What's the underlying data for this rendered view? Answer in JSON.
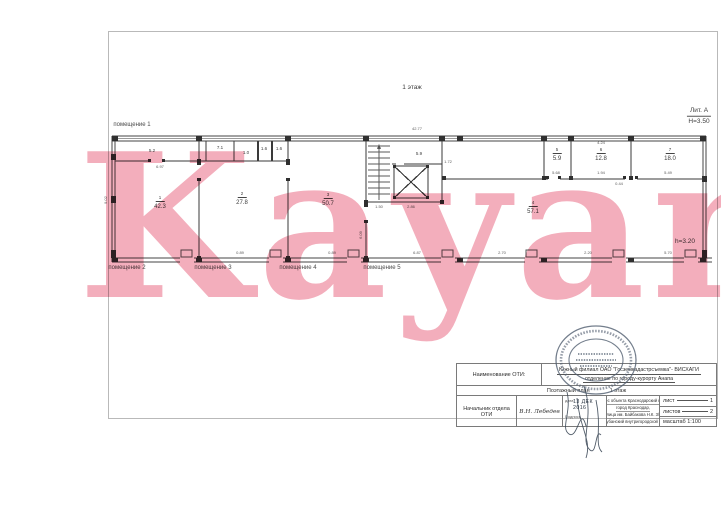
{
  "watermark": {
    "text": "Kayan",
    "color": "#f3aebc"
  },
  "plan": {
    "labels": [
      {
        "t": "1 этаж",
        "x": 412,
        "y": 88,
        "cls": "note"
      },
      {
        "t": "Лит. А",
        "x": 699,
        "y": 112,
        "cls": "lit"
      },
      {
        "t": "H=3.50",
        "x": 699,
        "y": 122,
        "cls": "note"
      },
      {
        "t": "h=3.20",
        "x": 685,
        "y": 242,
        "cls": "note"
      },
      {
        "t": "помещение 1",
        "x": 132,
        "y": 125,
        "cls": "name"
      },
      {
        "t": "помещение 2",
        "x": 127,
        "y": 268,
        "cls": "name"
      },
      {
        "t": "помещение 3",
        "x": 213,
        "y": 268,
        "cls": "name"
      },
      {
        "t": "помещение 4",
        "x": 298,
        "y": 268,
        "cls": "name"
      },
      {
        "t": "помещение 5",
        "x": 382,
        "y": 268,
        "cls": "name"
      },
      {
        "t": "1",
        "x": 160,
        "y": 199,
        "cls": "rnum"
      },
      {
        "t": "42.3",
        "x": 160,
        "y": 207,
        "cls": "area"
      },
      {
        "t": "2",
        "x": 242,
        "y": 195,
        "cls": "rnum"
      },
      {
        "t": "27.8",
        "x": 242,
        "y": 203,
        "cls": "area"
      },
      {
        "t": "3",
        "x": 328,
        "y": 196,
        "cls": "rnum"
      },
      {
        "t": "50.7",
        "x": 328,
        "y": 204,
        "cls": "area"
      },
      {
        "t": "4",
        "x": 533,
        "y": 204,
        "cls": "rnum"
      },
      {
        "t": "57.1",
        "x": 533,
        "y": 212,
        "cls": "area"
      },
      {
        "t": "5",
        "x": 557,
        "y": 151,
        "cls": "rnum"
      },
      {
        "t": "5.9",
        "x": 557,
        "y": 159,
        "cls": "area"
      },
      {
        "t": "6",
        "x": 601,
        "y": 151,
        "cls": "rnum"
      },
      {
        "t": "12.8",
        "x": 601,
        "y": 159,
        "cls": "area"
      },
      {
        "t": "7",
        "x": 670,
        "y": 151,
        "cls": "rnum"
      },
      {
        "t": "18.0",
        "x": 670,
        "y": 159,
        "cls": "area"
      },
      {
        "t": "5.2",
        "x": 152,
        "y": 151,
        "cls": "tiny"
      },
      {
        "t": "7.1",
        "x": 220,
        "y": 148,
        "cls": "tiny"
      },
      {
        "t": "1.0",
        "x": 246,
        "y": 153,
        "cls": "tiny"
      },
      {
        "t": "1.6",
        "x": 264,
        "y": 149,
        "cls": "tiny"
      },
      {
        "t": "1.6",
        "x": 279,
        "y": 149,
        "cls": "tiny"
      },
      {
        "t": "5.9",
        "x": 419,
        "y": 154,
        "cls": "tiny"
      },
      {
        "t": "42.77",
        "x": 417,
        "y": 129,
        "cls": "dim"
      },
      {
        "t": "6.97",
        "x": 160,
        "y": 167,
        "cls": "dim"
      },
      {
        "t": "9.02",
        "x": 106,
        "y": 200,
        "cls": "dim",
        "rot": -90
      },
      {
        "t": "6.09",
        "x": 361,
        "y": 235,
        "cls": "dim",
        "rot": -90
      },
      {
        "t": "1.72",
        "x": 448,
        "y": 162,
        "cls": "dim"
      },
      {
        "t": "2.86",
        "x": 411,
        "y": 207,
        "cls": "dim"
      },
      {
        "t": "1.50",
        "x": 379,
        "y": 207,
        "cls": "dim"
      },
      {
        "t": "5.68",
        "x": 556,
        "y": 173,
        "cls": "dim"
      },
      {
        "t": "1.94",
        "x": 601,
        "y": 173,
        "cls": "dim"
      },
      {
        "t": "5.49",
        "x": 668,
        "y": 173,
        "cls": "dim"
      },
      {
        "t": "0.44",
        "x": 619,
        "y": 184,
        "cls": "dim"
      },
      {
        "t": "4.24",
        "x": 601,
        "y": 143,
        "cls": "dim"
      },
      {
        "t": "0.89",
        "x": 240,
        "y": 253,
        "cls": "dim"
      },
      {
        "t": "0.89",
        "x": 332,
        "y": 253,
        "cls": "dim"
      },
      {
        "t": "6.87",
        "x": 417,
        "y": 253,
        "cls": "dim"
      },
      {
        "t": "2.70",
        "x": 502,
        "y": 253,
        "cls": "dim"
      },
      {
        "t": "2.20",
        "x": 588,
        "y": 253,
        "cls": "dim"
      },
      {
        "t": "5.70",
        "x": 668,
        "y": 253,
        "cls": "dim"
      }
    ]
  },
  "titleblock": {
    "oti_label": "Наименование ОТИ:",
    "org_line1": "Южный филиал ОАО \"Госземкадастрсъемка\"- ВИСХАГИ",
    "org_line2": "отделение по городу-курорту Анапа",
    "plan_row_label": "Поэтажный план",
    "plan_row_suffix": "1 этаж",
    "post_label": "Начальник отдела ОТИ",
    "signer_name": "В.Н. Лебедев",
    "date_label": "дата",
    "date_value": "13 ДЕК 2016",
    "sign_label": "Подпись",
    "address_lines": [
      "Адрес объекта Краснодарский край,",
      "город Краснодар,",
      "улица им. Байбакова Н.К. 3/1",
      "Прикубанский внутригородской округ"
    ],
    "sheet_label": "лист",
    "sheet_value": "1",
    "sheets_label": "листов",
    "sheets_value": "2",
    "scale_label": "масштаб 1:100"
  }
}
